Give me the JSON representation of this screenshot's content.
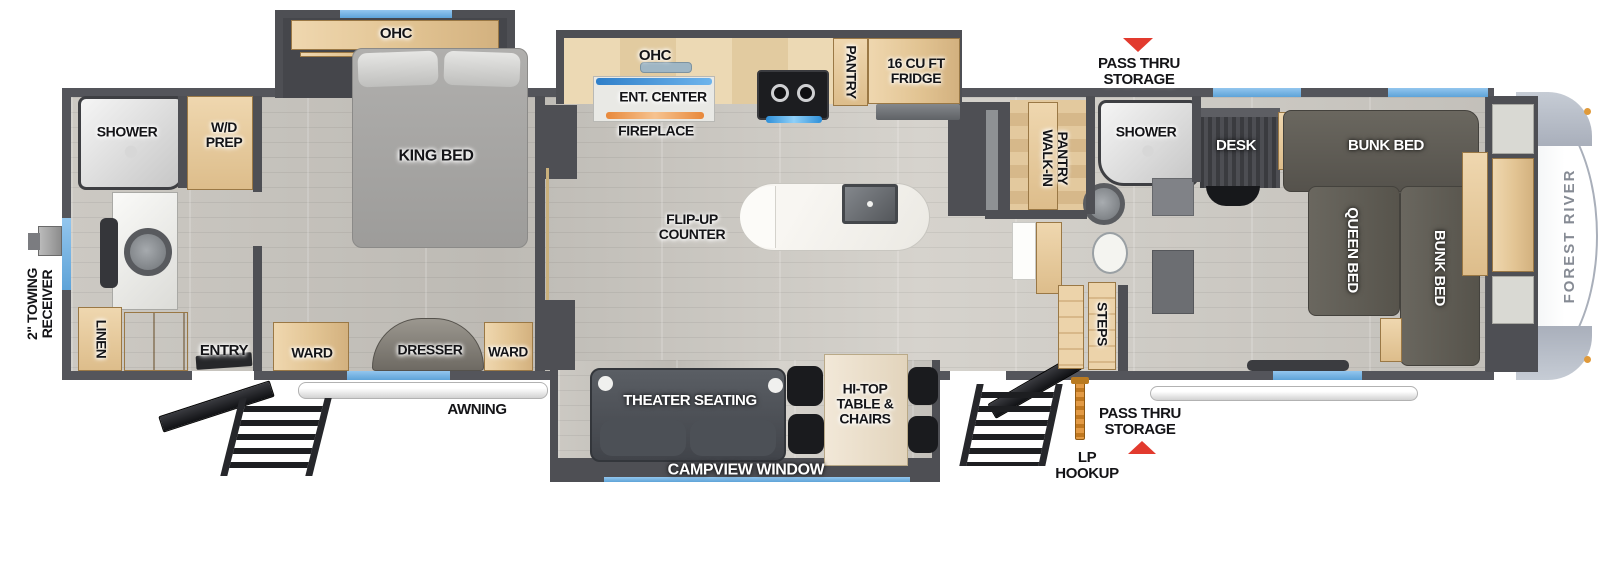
{
  "brand": {
    "name": "FOREST RIVER"
  },
  "colors": {
    "wall_gray": "#4e4f54",
    "accent_blue": "#6fb1e3",
    "alert_red": "#e23a2e",
    "lp_orange": "#dd8a33",
    "cabinet_tan": "#e2c493"
  },
  "exterior": {
    "towing_receiver": "2\" TOWING\nRECEIVER",
    "awning": "AWNING",
    "pass_thru_top": "PASS THRU\nSTORAGE",
    "pass_thru_bottom": "PASS THRU\nSTORAGE",
    "lp_hookup": "LP\nHOOKUP"
  },
  "rear_bath": {
    "shower": "SHOWER",
    "wd_prep": "W/D\nPREP",
    "linen": "LINEN",
    "entry": "ENTRY"
  },
  "bedroom": {
    "ohc": "OHC",
    "king_bed": "KING BED",
    "ward_left": "WARD",
    "dresser": "DRESSER",
    "ward_right": "WARD"
  },
  "kitchen": {
    "ohc": "OHC",
    "ent_center": "ENT. CENTER",
    "fireplace": "FIREPLACE",
    "pantry": "PANTRY",
    "fridge": "16 CU FT\nFRIDGE",
    "flip_up_counter": "FLIP-UP\nCOUNTER"
  },
  "living": {
    "theater_seating": "THEATER SEATING",
    "hi_top": "HI-TOP\nTABLE &\nCHAIRS",
    "campview_window": "CAMPVIEW WINDOW"
  },
  "mid_bath": {
    "walk_in_pantry": "WALK-IN\nPANTRY",
    "shower": "SHOWER",
    "steps": "STEPS"
  },
  "bunk_room": {
    "desk": "DESK",
    "bunk_bed_top": "BUNK BED",
    "queen_bed": "QUEEN BED",
    "bunk_bed_right": "BUNK BED"
  }
}
